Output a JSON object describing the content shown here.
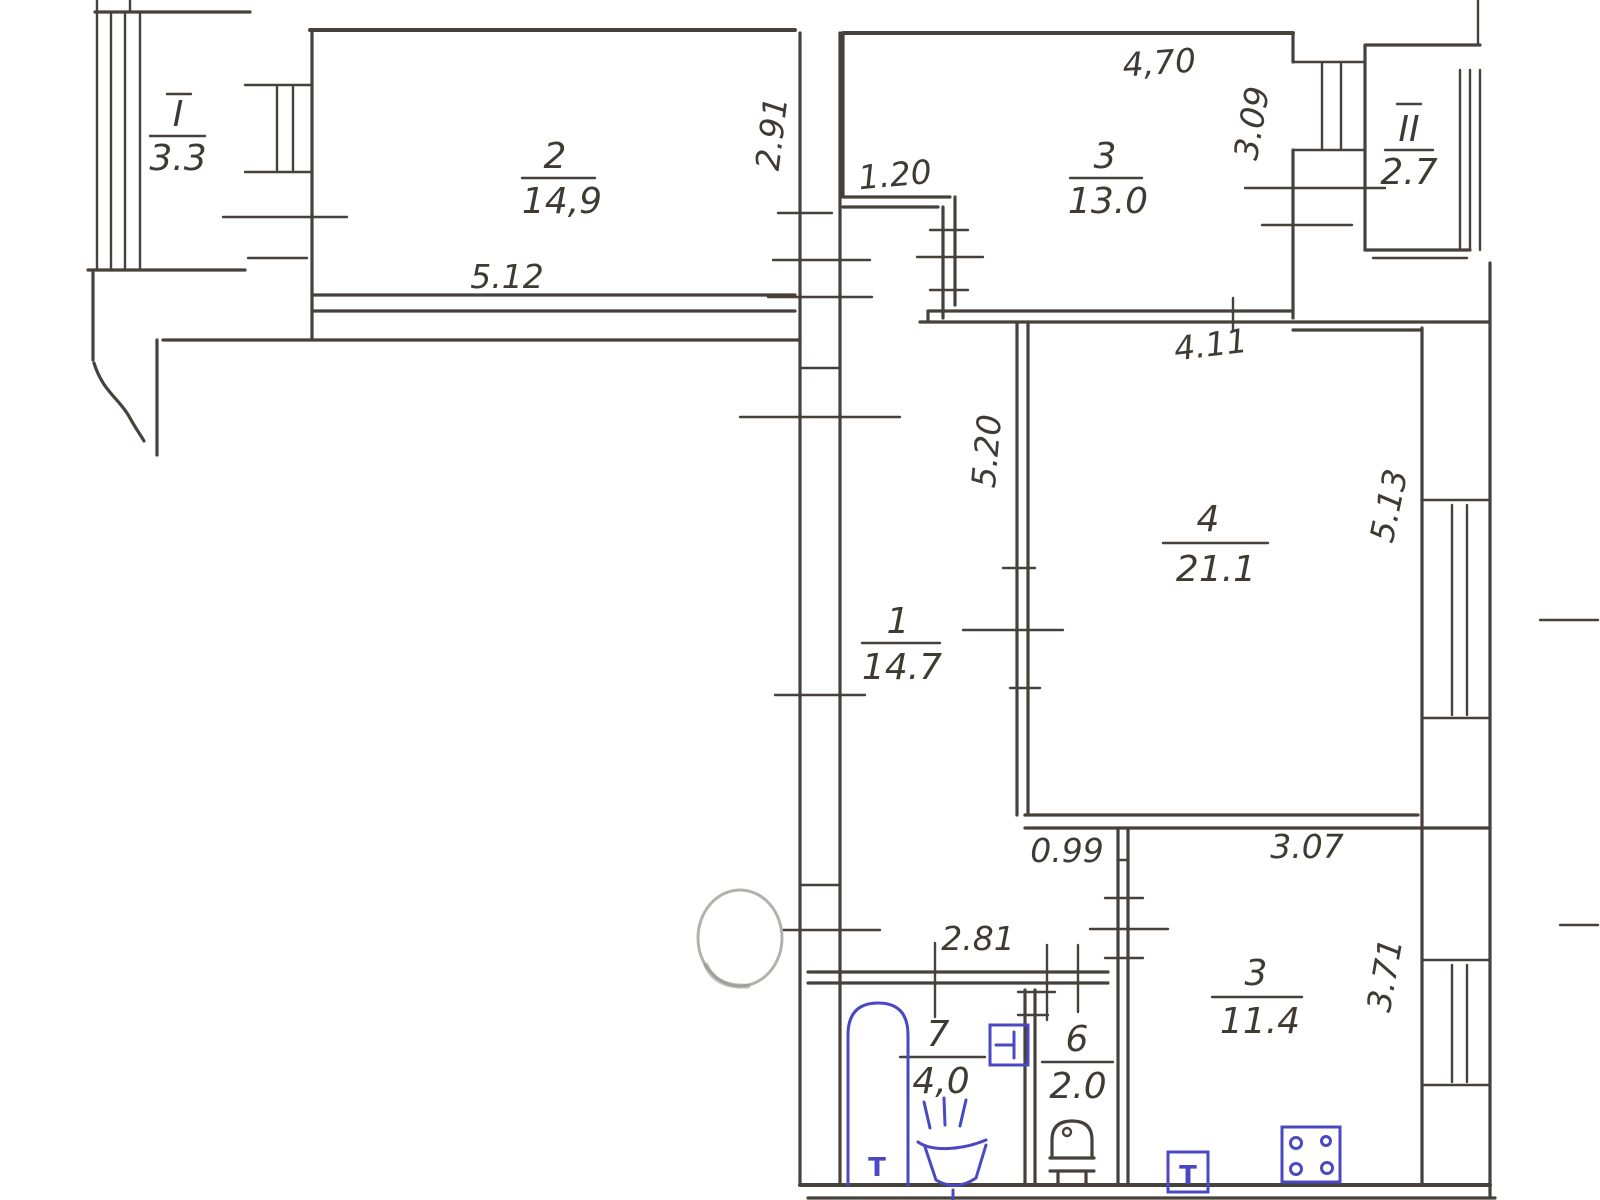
{
  "drawing": {
    "type": "hand-drawn apartment floor plan (scanned sketch)",
    "ink_color": "#46413a",
    "fixture_color": "#4a48c2",
    "background": "#ffffff"
  },
  "rooms": [
    {
      "id": "balcony-1",
      "number": "I",
      "area": "3.3"
    },
    {
      "id": "room-2",
      "number": "2",
      "area": "14,9"
    },
    {
      "id": "room-3-top",
      "number": "3",
      "area": "13.0"
    },
    {
      "id": "balcony-2",
      "number": "II",
      "area": "2.7"
    },
    {
      "id": "room-1-hall",
      "number": "1",
      "area": "14.7"
    },
    {
      "id": "room-4",
      "number": "4",
      "area": "21.1"
    },
    {
      "id": "room-7-bath",
      "number": "7",
      "area": "4,0"
    },
    {
      "id": "room-6-wc",
      "number": "6",
      "area": "2.0"
    },
    {
      "id": "room-3-kitchen",
      "number": "3",
      "area": "11.4"
    }
  ],
  "dims": [
    {
      "id": "dim-5-12",
      "value": "5.12"
    },
    {
      "id": "dim-2-91",
      "value": "2.91"
    },
    {
      "id": "dim-1-20",
      "value": "1.20"
    },
    {
      "id": "dim-4-70",
      "value": "4,70"
    },
    {
      "id": "dim-3-09",
      "value": "3.09"
    },
    {
      "id": "dim-5-20",
      "value": "5.20"
    },
    {
      "id": "dim-4-11",
      "value": "4.11"
    },
    {
      "id": "dim-5-13",
      "value": "5.13"
    },
    {
      "id": "dim-0-99",
      "value": "0.99"
    },
    {
      "id": "dim-3-07",
      "value": "3.07"
    },
    {
      "id": "dim-2-81",
      "value": "2.81"
    },
    {
      "id": "dim-3-71",
      "value": "3.71"
    }
  ],
  "fixtures": {
    "bathtub_label": "T",
    "kitchen_sink_label": "T",
    "items": [
      "bathtub",
      "bath-sink",
      "water-heater-box",
      "toilet",
      "kitchen-sink",
      "stove-4-burner",
      "eraser-mark"
    ]
  }
}
